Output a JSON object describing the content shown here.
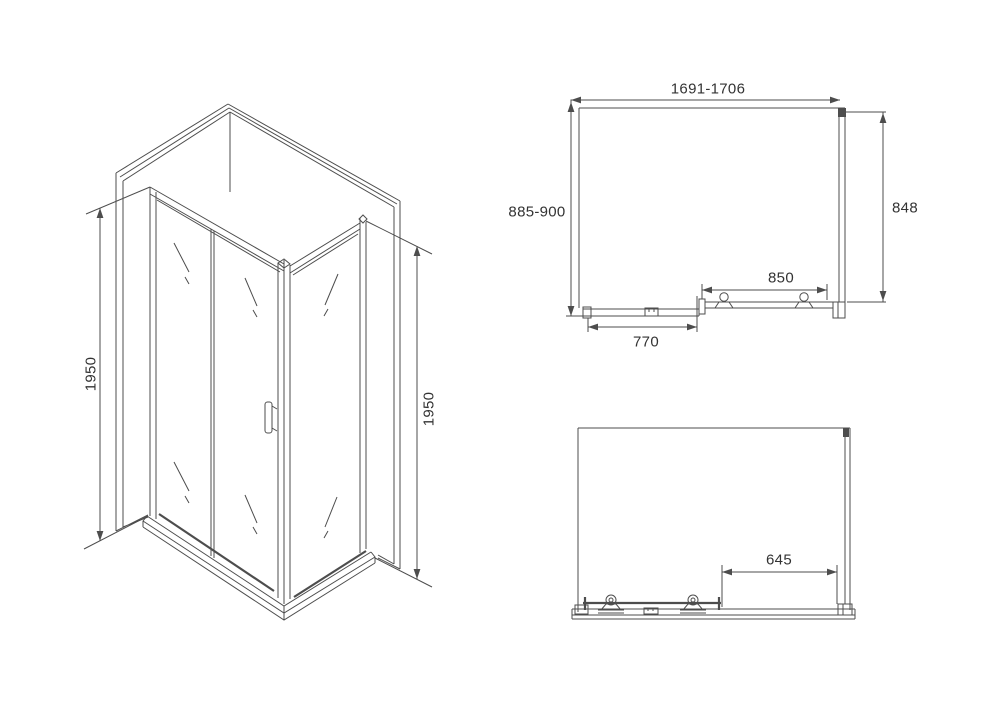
{
  "meta": {
    "description": "Technical dimensional drawing of a corner shower enclosure with sliding door: isometric view, plan (top) view and front view"
  },
  "dimensions": {
    "iso_left_height": "1950",
    "iso_right_height": "1950",
    "plan_width_range": "1691-1706",
    "plan_depth_range": "885-900",
    "plan_side_depth": "848",
    "plan_door_width": "850",
    "plan_fixed_panel_width": "770",
    "front_door_offset": "645"
  },
  "colors": {
    "line": "#4d4d4d",
    "text": "#333333",
    "background": "#ffffff"
  }
}
